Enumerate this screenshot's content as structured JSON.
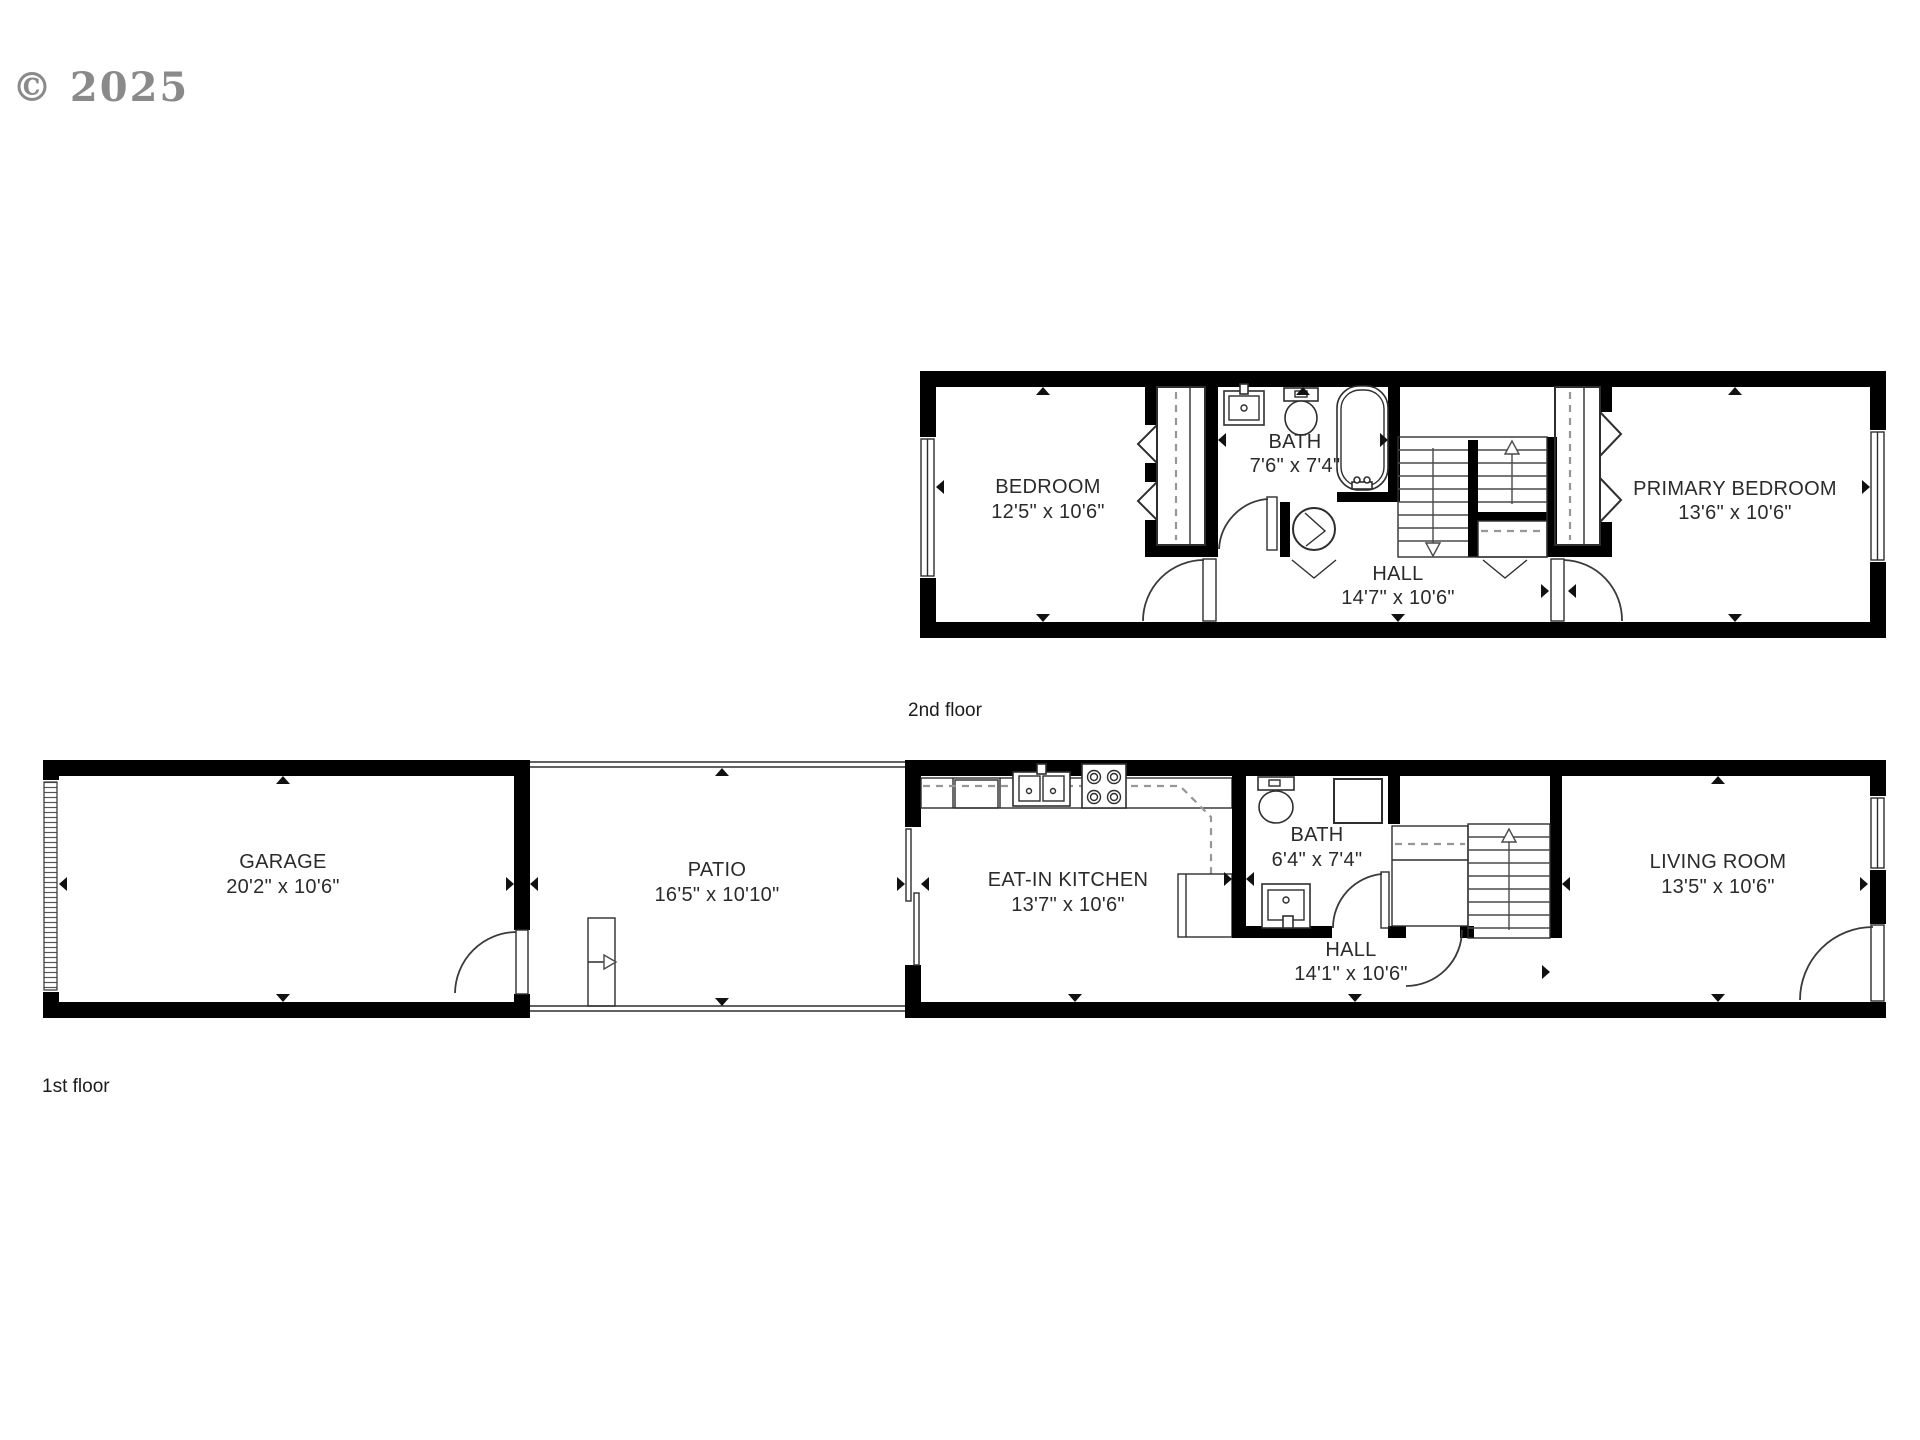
{
  "watermark": "© 2025",
  "colors": {
    "wall": "#000000",
    "line": "#2e2e2e",
    "dash": "#979797",
    "text": "#2b2b2b",
    "watermark": "#8a8a8a",
    "background": "#ffffff"
  },
  "floors": [
    {
      "label": "2nd floor",
      "rooms": [
        {
          "name": "BEDROOM",
          "dims": "12'5\" x 10'6\""
        },
        {
          "name": "BATH",
          "dims": "7'6\" x 7'4\""
        },
        {
          "name": "HALL",
          "dims": "14'7\" x 10'6\""
        },
        {
          "name": "PRIMARY BEDROOM",
          "dims": "13'6\" x 10'6\""
        }
      ]
    },
    {
      "label": "1st floor",
      "rooms": [
        {
          "name": "GARAGE",
          "dims": "20'2\" x 10'6\""
        },
        {
          "name": "PATIO",
          "dims": "16'5\" x 10'10\""
        },
        {
          "name": "EAT-IN KITCHEN",
          "dims": "13'7\" x 10'6\""
        },
        {
          "name": "BATH",
          "dims": "6'4\" x 7'4\""
        },
        {
          "name": "HALL",
          "dims": "14'1\" x 10'6\""
        },
        {
          "name": "LIVING ROOM",
          "dims": "13'5\" x 10'6\""
        }
      ]
    }
  ]
}
